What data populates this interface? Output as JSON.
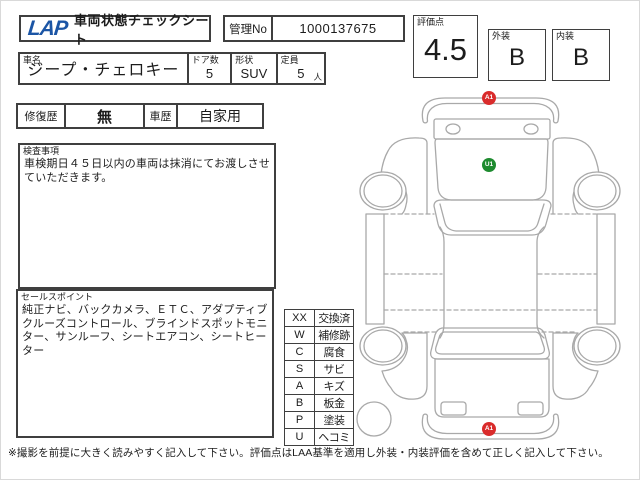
{
  "header": {
    "logo": "LAP",
    "title": "車両状態チェックシート",
    "management_no_label": "管理No",
    "management_no": "1000137675"
  },
  "scores": {
    "overall_label": "評価点",
    "overall": "4.5",
    "exterior_label": "外装",
    "exterior": "B",
    "interior_label": "内装",
    "interior": "B"
  },
  "vehicle": {
    "name_label": "車名",
    "name": "ジープ・チェロキー",
    "doors_label": "ドア数",
    "doors": "5",
    "shape_label": "形状",
    "shape": "SUV",
    "capacity_label": "定員",
    "capacity": "5",
    "capacity_unit": "人"
  },
  "history": {
    "repair_label": "修復歴",
    "repair": "無",
    "usage_label": "車歴",
    "usage": "自家用"
  },
  "inspection": {
    "label": "検査事項",
    "text": "車検期日４５日以内の車両は抹消にてお渡しさせていただきます。"
  },
  "sales_points": {
    "label": "セールスポイント",
    "text": "純正ナビ、バックカメラ、ＥＴＣ、アダプティブクルーズコントロール、ブラインドスポットモニター、サンルーフ、シートエアコン、シートヒーター"
  },
  "legend": {
    "rows": [
      {
        "code": "XX",
        "label": "交換済"
      },
      {
        "code": "W",
        "label": "補修跡"
      },
      {
        "code": "C",
        "label": "腐食"
      },
      {
        "code": "S",
        "label": "サビ"
      },
      {
        "code": "A",
        "label": "キズ"
      },
      {
        "code": "B",
        "label": "板金"
      },
      {
        "code": "P",
        "label": "塗装"
      },
      {
        "code": "U",
        "label": "ヘコミ"
      }
    ]
  },
  "diagram": {
    "markers": [
      {
        "id": "A1",
        "position": "front-bumper",
        "color": "#d92b2b"
      },
      {
        "id": "U1",
        "position": "hood",
        "color": "#1e8b2f"
      },
      {
        "id": "A1",
        "position": "rear-bumper",
        "color": "#d92b2b"
      }
    ]
  },
  "footer": {
    "note": "※撮影を前提に大きく読みやすく記入して下さい。評価点はLAA基準を適用し外装・内装評価を含めて正しく記入して下さい。"
  },
  "colors": {
    "logo_blue": "#1b55a5",
    "marker_red": "#d92b2b",
    "marker_green": "#1e8b2f",
    "line_gray": "#a9a9a9"
  }
}
